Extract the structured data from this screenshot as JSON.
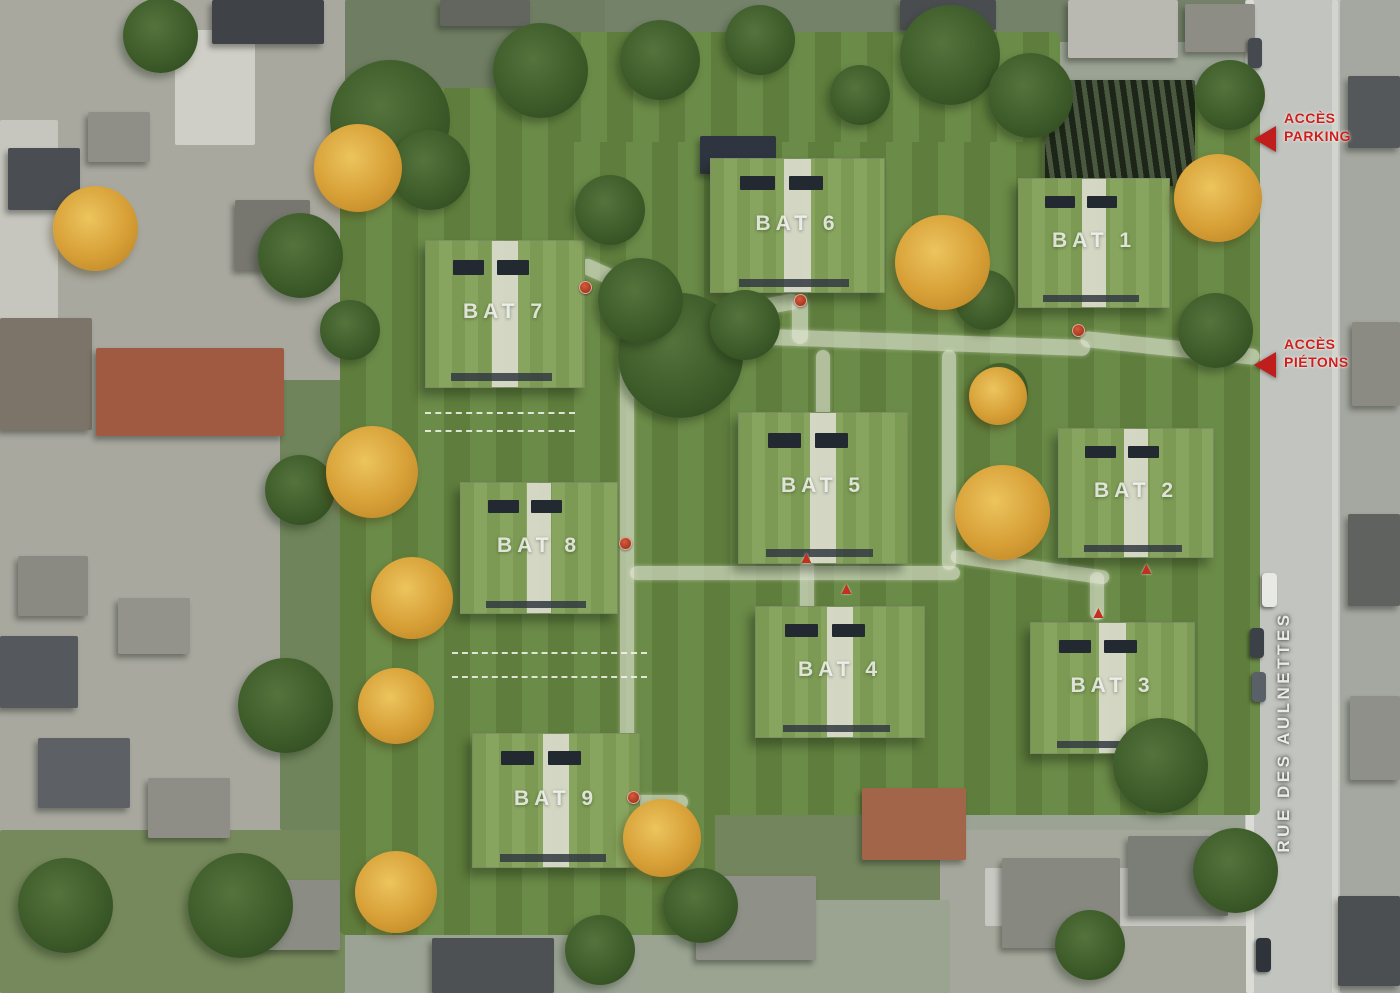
{
  "map": {
    "type": "aerial-site-plan",
    "street_label": "RUE DES AULNETTES",
    "annotations": [
      {
        "id": "access-parking",
        "line1": "ACCÈS",
        "line2": "PARKING",
        "x": 1284,
        "y": 110,
        "arrow_x": 1254,
        "arrow_y": 126
      },
      {
        "id": "access-pietons",
        "line1": "ACCÈS",
        "line2": "PIÉTONS",
        "x": 1284,
        "y": 336,
        "arrow_x": 1254,
        "arrow_y": 352
      }
    ],
    "accent_red": "#c01d1d",
    "lawn_green": "#5f7e3d",
    "roof_green": "#7c9a53",
    "buildings": [
      {
        "label": "BAT 7",
        "x": 425,
        "y": 240,
        "w": 160,
        "h": 148
      },
      {
        "label": "BAT 6",
        "x": 710,
        "y": 158,
        "w": 175,
        "h": 135
      },
      {
        "label": "BAT 1",
        "x": 1018,
        "y": 178,
        "w": 152,
        "h": 130
      },
      {
        "label": "BAT 5",
        "x": 738,
        "y": 412,
        "w": 170,
        "h": 152
      },
      {
        "label": "BAT 2",
        "x": 1058,
        "y": 428,
        "w": 156,
        "h": 130
      },
      {
        "label": "BAT 8",
        "x": 460,
        "y": 482,
        "w": 158,
        "h": 132
      },
      {
        "label": "BAT 4",
        "x": 755,
        "y": 606,
        "w": 170,
        "h": 132
      },
      {
        "label": "BAT 3",
        "x": 1030,
        "y": 622,
        "w": 165,
        "h": 132
      },
      {
        "label": "BAT 9",
        "x": 472,
        "y": 733,
        "w": 168,
        "h": 135
      }
    ],
    "zones": [
      {
        "x": 0,
        "y": 0,
        "w": 345,
        "h": 993,
        "c": "#a8a89f"
      },
      {
        "x": 345,
        "y": 0,
        "w": 905,
        "h": 42,
        "c": "#75826a"
      },
      {
        "x": 345,
        "y": 0,
        "w": 260,
        "h": 100,
        "c": "#6f7d62"
      },
      {
        "x": 1245,
        "y": 0,
        "w": 100,
        "h": 993,
        "c": "#c2c4bf"
      },
      {
        "x": 1340,
        "y": 0,
        "w": 60,
        "h": 993,
        "c": "#a5a8a0"
      },
      {
        "x": 0,
        "y": 830,
        "w": 345,
        "h": 163,
        "c": "#76895c"
      },
      {
        "x": 280,
        "y": 380,
        "w": 70,
        "h": 450,
        "c": "#6f845a"
      },
      {
        "x": 700,
        "y": 800,
        "w": 260,
        "h": 110,
        "c": "#72855c"
      },
      {
        "x": 940,
        "y": 830,
        "w": 310,
        "h": 163,
        "c": "#a5a79c"
      },
      {
        "x": 640,
        "y": 900,
        "w": 310,
        "h": 93,
        "c": "#9aa491"
      }
    ],
    "roads": [
      {
        "x": 175,
        "y": 30,
        "w": 80,
        "h": 115,
        "c": "#cfcfc8"
      },
      {
        "x": 0,
        "y": 120,
        "w": 58,
        "h": 240,
        "c": "#c6c6bf"
      },
      {
        "x": 985,
        "y": 868,
        "w": 270,
        "h": 58,
        "c": "#c8c8c2"
      },
      {
        "x": 1246,
        "y": 0,
        "w": 8,
        "h": 993,
        "c": "#dcdcd6"
      },
      {
        "x": 1332,
        "y": 0,
        "w": 6,
        "h": 993,
        "c": "#d4d4ce"
      }
    ],
    "green_zones": [
      {
        "x": 340,
        "y": 88,
        "w": 912,
        "h": 525
      },
      {
        "x": 340,
        "y": 90,
        "w": 375,
        "h": 845
      },
      {
        "x": 600,
        "y": 85,
        "w": 660,
        "h": 730
      },
      {
        "x": 555,
        "y": 32,
        "w": 505,
        "h": 110
      }
    ],
    "paths": [
      {
        "x": 575,
        "y": 280,
        "w": 120,
        "h": 16,
        "r": 24
      },
      {
        "x": 690,
        "y": 302,
        "w": 110,
        "h": 16,
        "r": -10
      },
      {
        "x": 620,
        "y": 332,
        "w": 470,
        "h": 16,
        "r": 2
      },
      {
        "x": 1080,
        "y": 340,
        "w": 180,
        "h": 16,
        "r": 6
      },
      {
        "x": 792,
        "y": 296,
        "w": 16,
        "h": 48,
        "r": 0
      },
      {
        "x": 816,
        "y": 350,
        "w": 14,
        "h": 70,
        "r": 0
      },
      {
        "x": 942,
        "y": 350,
        "w": 14,
        "h": 220,
        "r": 0
      },
      {
        "x": 620,
        "y": 345,
        "w": 14,
        "h": 460,
        "r": 0
      },
      {
        "x": 630,
        "y": 566,
        "w": 330,
        "h": 14,
        "r": 0
      },
      {
        "x": 950,
        "y": 560,
        "w": 160,
        "h": 14,
        "r": 8
      },
      {
        "x": 1090,
        "y": 572,
        "w": 14,
        "h": 48,
        "r": 0
      },
      {
        "x": 800,
        "y": 560,
        "w": 14,
        "h": 55,
        "r": 0
      },
      {
        "x": 628,
        "y": 795,
        "w": 60,
        "h": 14,
        "r": 0
      }
    ],
    "parking_lines": [
      {
        "x": 452,
        "y": 652,
        "w": 195,
        "h": 26
      },
      {
        "x": 425,
        "y": 412,
        "w": 150,
        "h": 20
      }
    ],
    "houses": [
      {
        "x": 8,
        "y": 148,
        "w": 72,
        "h": 62,
        "c": "#4a4e52"
      },
      {
        "x": 88,
        "y": 112,
        "w": 62,
        "h": 50,
        "c": "#8f8f88"
      },
      {
        "x": 0,
        "y": 318,
        "w": 92,
        "h": 112,
        "c": "#7c7468"
      },
      {
        "x": 96,
        "y": 348,
        "w": 188,
        "h": 88,
        "c": "#a05a41"
      },
      {
        "x": 18,
        "y": 556,
        "w": 70,
        "h": 60,
        "c": "#8a8a82"
      },
      {
        "x": 0,
        "y": 636,
        "w": 78,
        "h": 72,
        "c": "#55585c"
      },
      {
        "x": 118,
        "y": 598,
        "w": 72,
        "h": 56,
        "c": "#93938b"
      },
      {
        "x": 38,
        "y": 738,
        "w": 92,
        "h": 70,
        "c": "#5d6064"
      },
      {
        "x": 148,
        "y": 778,
        "w": 82,
        "h": 60,
        "c": "#8e8e86"
      },
      {
        "x": 235,
        "y": 200,
        "w": 75,
        "h": 70,
        "c": "#77776f"
      },
      {
        "x": 212,
        "y": 0,
        "w": 112,
        "h": 44,
        "c": "#3f4246"
      },
      {
        "x": 440,
        "y": 0,
        "w": 90,
        "h": 26,
        "c": "#63665e"
      },
      {
        "x": 700,
        "y": 136,
        "w": 76,
        "h": 38,
        "c": "#2e3540"
      },
      {
        "x": 900,
        "y": 0,
        "w": 96,
        "h": 30,
        "c": "#4a4d50"
      },
      {
        "x": 1068,
        "y": 0,
        "w": 110,
        "h": 58,
        "c": "#b9b9b2"
      },
      {
        "x": 1185,
        "y": 4,
        "w": 70,
        "h": 48,
        "c": "#8d8d85"
      },
      {
        "x": 1348,
        "y": 76,
        "w": 52,
        "h": 72,
        "c": "#55585a"
      },
      {
        "x": 1352,
        "y": 322,
        "w": 48,
        "h": 84,
        "c": "#8b8b84"
      },
      {
        "x": 1348,
        "y": 514,
        "w": 52,
        "h": 92,
        "c": "#5f625f"
      },
      {
        "x": 1350,
        "y": 696,
        "w": 50,
        "h": 84,
        "c": "#90908a"
      },
      {
        "x": 1338,
        "y": 896,
        "w": 62,
        "h": 90,
        "c": "#4c4f52"
      },
      {
        "x": 696,
        "y": 876,
        "w": 120,
        "h": 84,
        "c": "#8f9189"
      },
      {
        "x": 862,
        "y": 788,
        "w": 104,
        "h": 72,
        "c": "#a2654a"
      },
      {
        "x": 1002,
        "y": 858,
        "w": 118,
        "h": 90,
        "c": "#878981"
      },
      {
        "x": 1128,
        "y": 836,
        "w": 100,
        "h": 80,
        "c": "#7b7e76"
      },
      {
        "x": 432,
        "y": 938,
        "w": 122,
        "h": 55,
        "c": "#4e5154"
      },
      {
        "x": 250,
        "y": 880,
        "w": 90,
        "h": 70,
        "c": "#8b8d84"
      }
    ],
    "hatch": {
      "x": 1045,
      "y": 80,
      "w": 150,
      "h": 106
    },
    "cars": [
      {
        "x": 1262,
        "y": 573,
        "w": 15,
        "h": 34,
        "c": "#e8e8e4"
      },
      {
        "x": 1250,
        "y": 628,
        "w": 14,
        "h": 30,
        "c": "#3c4148"
      },
      {
        "x": 1252,
        "y": 672,
        "w": 14,
        "h": 30,
        "c": "#596068"
      },
      {
        "x": 1256,
        "y": 938,
        "w": 15,
        "h": 34,
        "c": "#2f343a"
      },
      {
        "x": 1248,
        "y": 38,
        "w": 14,
        "h": 30,
        "c": "#454a50"
      }
    ],
    "trees_green": [
      [
        390,
        120,
        120
      ],
      [
        540,
        70,
        95
      ],
      [
        660,
        60,
        80
      ],
      [
        760,
        40,
        70
      ],
      [
        950,
        55,
        100
      ],
      [
        1030,
        95,
        85
      ],
      [
        860,
        95,
        60
      ],
      [
        160,
        35,
        75
      ],
      [
        300,
        255,
        85
      ],
      [
        300,
        490,
        70
      ],
      [
        285,
        705,
        95
      ],
      [
        240,
        905,
        105
      ],
      [
        65,
        905,
        95
      ],
      [
        680,
        355,
        125
      ],
      [
        640,
        300,
        85
      ],
      [
        745,
        325,
        70
      ],
      [
        610,
        210,
        70
      ],
      [
        430,
        170,
        80
      ],
      [
        985,
        300,
        60
      ],
      [
        1000,
        390,
        55
      ],
      [
        1215,
        330,
        75
      ],
      [
        1230,
        95,
        70
      ],
      [
        700,
        905,
        75
      ],
      [
        1160,
        765,
        95
      ],
      [
        1235,
        870,
        85
      ],
      [
        1090,
        945,
        70
      ],
      [
        600,
        950,
        70
      ],
      [
        350,
        330,
        60
      ]
    ],
    "trees_orange": [
      [
        95,
        228,
        85
      ],
      [
        358,
        168,
        88
      ],
      [
        372,
        472,
        92
      ],
      [
        412,
        598,
        82
      ],
      [
        396,
        706,
        76
      ],
      [
        396,
        892,
        82
      ],
      [
        662,
        838,
        78
      ],
      [
        942,
        262,
        95
      ],
      [
        1002,
        512,
        95
      ],
      [
        998,
        396,
        58
      ],
      [
        1218,
        198,
        88
      ]
    ],
    "markers_circle": [
      [
        585,
        287
      ],
      [
        800,
        300
      ],
      [
        1078,
        330
      ],
      [
        625,
        543
      ],
      [
        633,
        797
      ]
    ],
    "markers_triangle": [
      [
        806,
        557
      ],
      [
        846,
        588
      ],
      [
        1146,
        568
      ],
      [
        1098,
        612
      ]
    ]
  }
}
